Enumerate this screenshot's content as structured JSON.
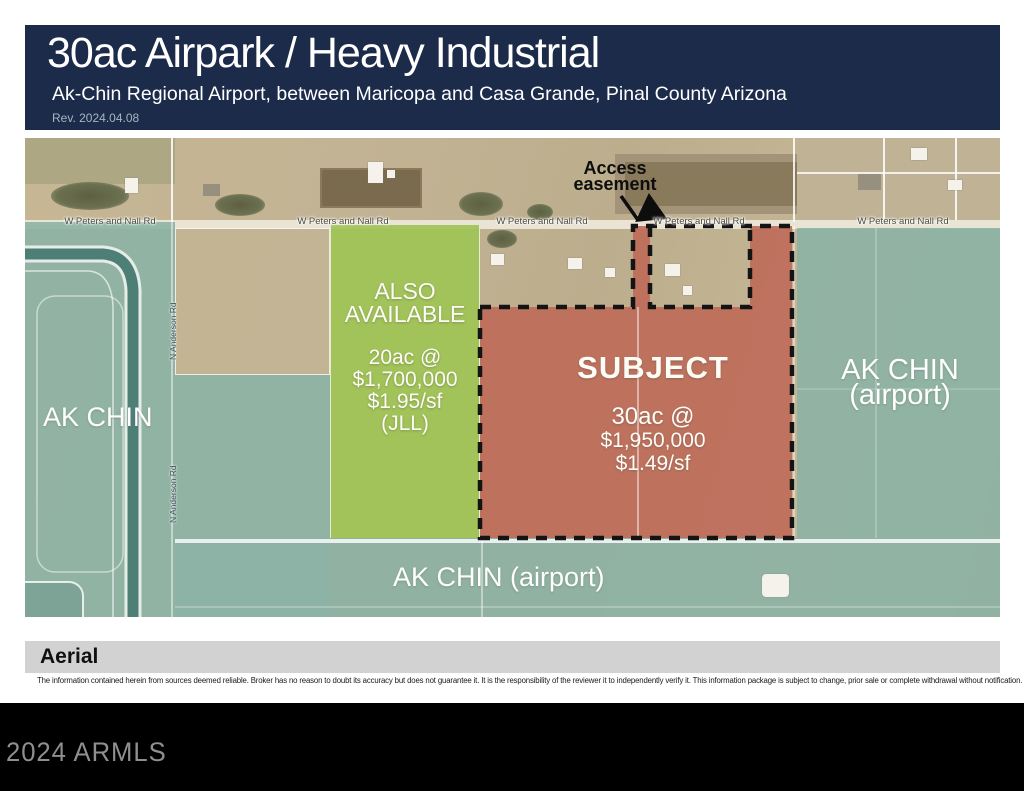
{
  "header": {
    "title": "30ac Airpark / Heavy Industrial",
    "subtitle": "Ak-Chin Regional Airport, between Maricopa and Casa Grande, Pinal County Arizona",
    "revision": "Rev. 2024.04.08",
    "bg_color": "#1c2b4a"
  },
  "map": {
    "road_label": "W Peters and Nall Rd",
    "vertical_road_label": "N Anderson Rd",
    "access_easement": {
      "line1": "Access",
      "line2": "easement"
    },
    "labels": {
      "ak_chin_left": "AK CHIN",
      "ak_chin_right_line1": "AK CHIN",
      "ak_chin_right_line2": "(airport)",
      "ak_chin_bottom": "AK CHIN (airport)"
    },
    "also_available": {
      "line1": "ALSO",
      "line2": "AVAILABLE",
      "acreage": "20ac @",
      "price": "$1,700,000",
      "price_per_sf": "$1.95/sf",
      "broker": "(JLL)",
      "overlay_color": "#a0c455"
    },
    "subject": {
      "label": "SUBJECT",
      "acreage": "30ac @",
      "price": "$1,950,000",
      "price_per_sf": "$1.49/sf",
      "overlay_color": "#bf6e5c"
    },
    "reservation_overlay_color": "#8cb3a5"
  },
  "section_label": "Aerial",
  "disclaimer": "The information contained herein from sources deemed reliable.  Broker has no reason to doubt its accuracy but does not guarantee it.  It is the responsibility of the reviewer it to independently verify it.  This information package is subject to change, prior sale or complete withdrawal without notification.",
  "watermark": "2024 ARMLS"
}
